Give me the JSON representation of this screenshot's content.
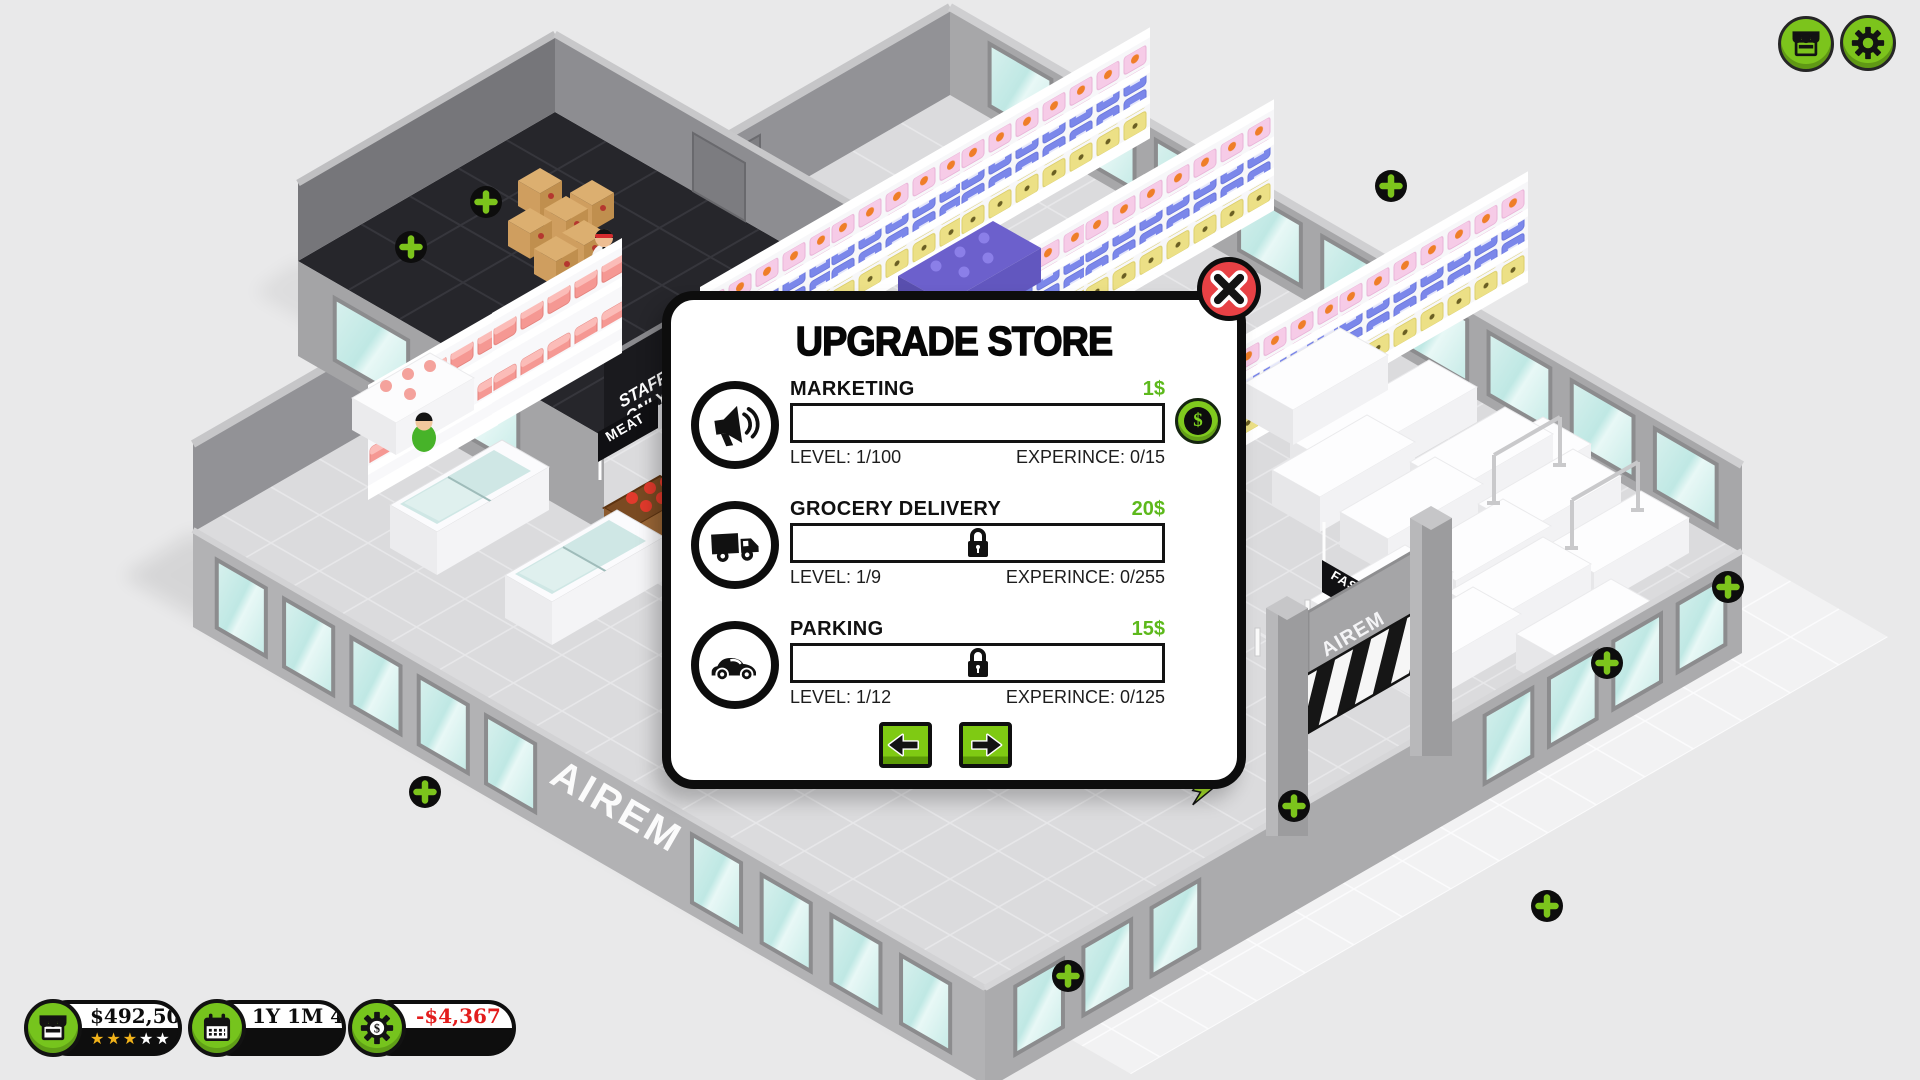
{
  "scene": {
    "brand_wall": "AIREM",
    "entrance_sign": "AIREM",
    "meat_sign": "MEAT",
    "fashion_sign": "FASHION",
    "staff_sign_line1": "STAFF",
    "staff_sign_line2": "ONLY"
  },
  "hud": {
    "money": "$492,500",
    "stars_gold": "★★★",
    "stars_empty": "★★",
    "game_time": "1Y 1M 4W",
    "balance_change": "-$4,367"
  },
  "modal": {
    "title": "UPGRADE STORE",
    "buy_symbol": "$",
    "upgrades": [
      {
        "name": "MARKETING",
        "price": "1$",
        "level": "LEVEL: 1/100",
        "experience": "EXPERINCE: 0/15"
      },
      {
        "name": "GROCERY DELIVERY",
        "price": "20$",
        "level": "LEVEL: 1/9",
        "experience": "EXPERINCE: 0/255"
      },
      {
        "name": "PARKING",
        "price": "15$",
        "level": "LEVEL: 1/12",
        "experience": "EXPERINCE: 0/125"
      }
    ]
  },
  "colors": {
    "accent_green": "#7cc41c",
    "price_green": "#5db91c",
    "close_red": "#e84145",
    "danger_red": "#e31d1d",
    "star_gold": "#f2b31a"
  }
}
